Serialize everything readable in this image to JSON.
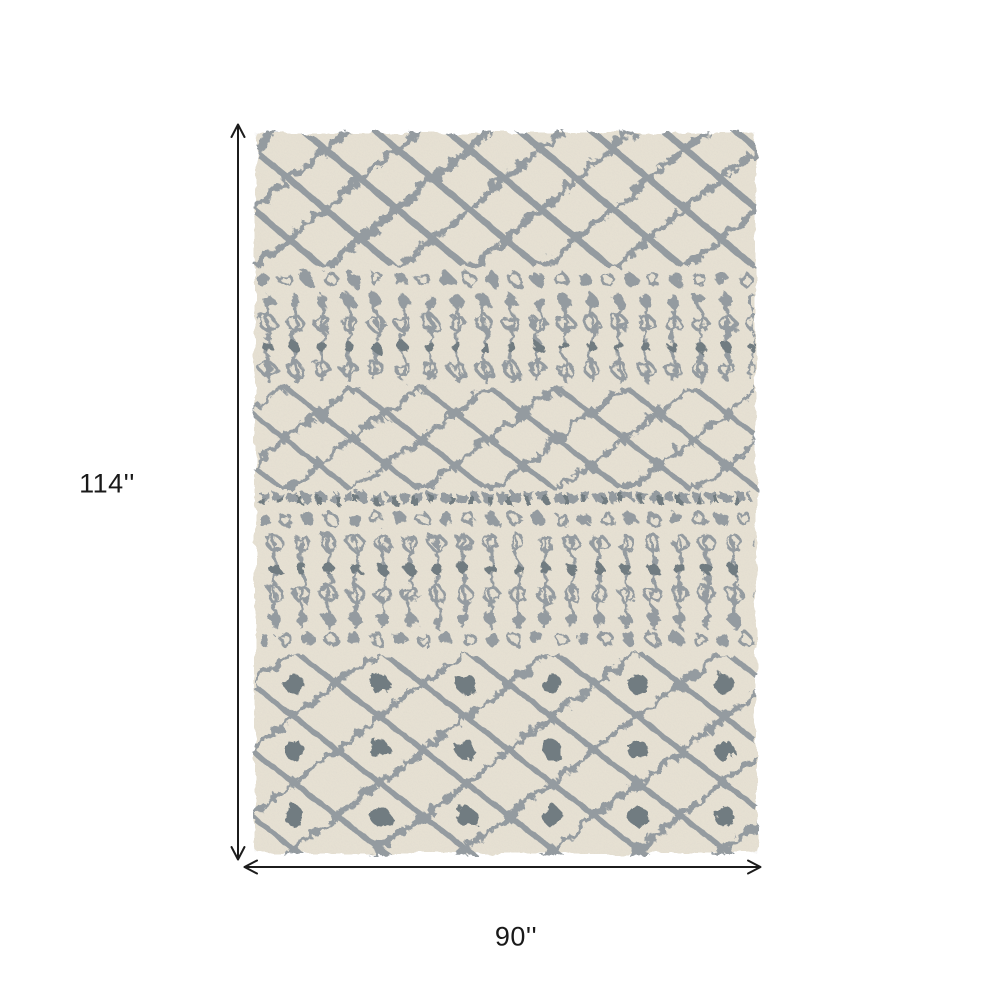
{
  "page": {
    "background": "#ffffff"
  },
  "image": {
    "type": "product-dimension-diagram",
    "alt": "Ivory and gray Moroccan lattice patterned shag area rug shown flat, annotated with height and width dimension arrows"
  },
  "dimensions": {
    "height": "114''",
    "width": "90''"
  },
  "icons": {
    "height_arrow": "double-headed-vertical-arrow-icon",
    "width_arrow": "double-headed-horizontal-arrow-icon",
    "arrowhead": "open-v-arrowhead-icon"
  },
  "colors": {
    "page_bg": "#ffffff",
    "rug_base": "#e9e3d5",
    "rug_base_light": "#f0ebe0",
    "pattern_gray": "#949ba0",
    "pattern_gray_dark": "#717b81",
    "arrow_black": "#1c1c1c",
    "label_text": "#191919"
  }
}
